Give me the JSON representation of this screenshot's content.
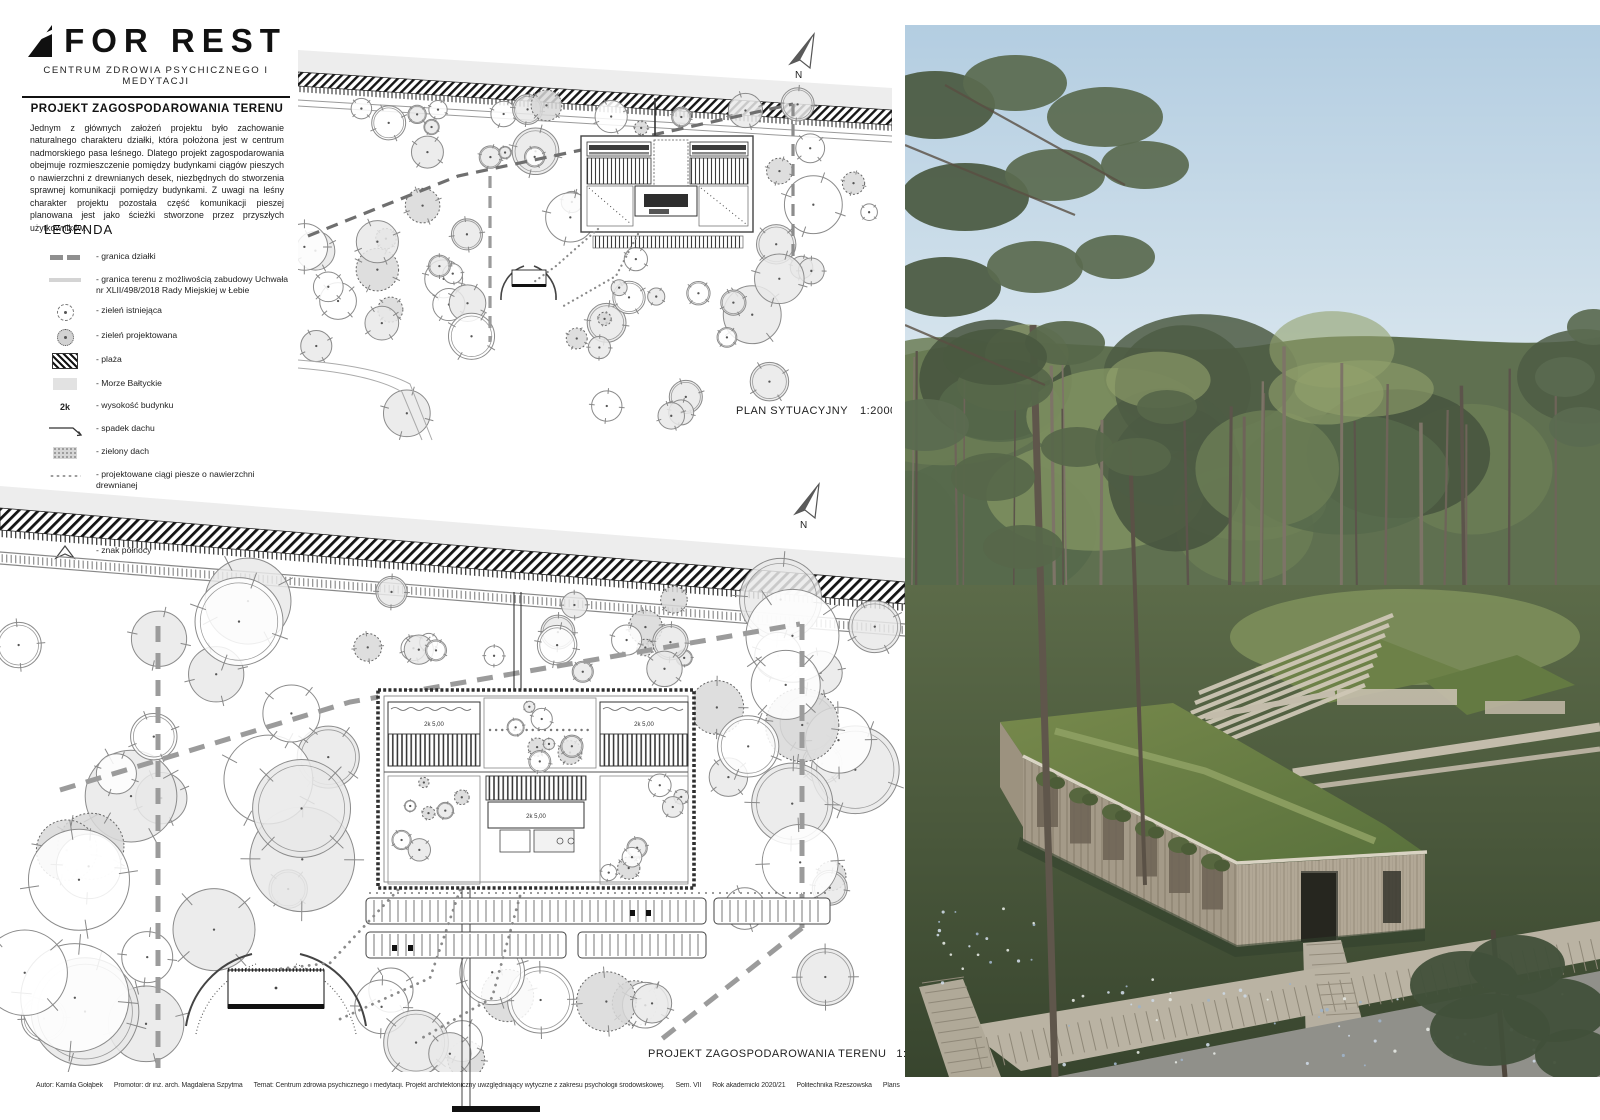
{
  "brand": {
    "logo_text": "FOR REST",
    "subtitle": "CENTRUM ZDROWIA PSYCHICZNEGO I MEDYTACJI"
  },
  "intro": {
    "heading": "PROJEKT ZAGOSPODAROWANIA TERENU",
    "body": "Jednym z głównych założeń projektu było zachowanie naturalnego charakteru działki, która położona jest w centrum nadmorskiego pasa leśnego. Dlatego projekt zagospodarowania obejmuje rozmieszczenie pomiędzy budynkami ciągów pieszych o nawierzchni z drewnianych desek, niezbędnych do stworzenia sprawnej komunikacji pomiędzy budynkami. Z uwagi na leśny charakter projektu pozostała część komunikacji pieszej planowana jest jako ścieżki stworzone przez przyszłych użytkowników."
  },
  "legend": {
    "title": "LEGENDA",
    "items": [
      {
        "icon": "boundary-dash-icon",
        "label": "- granica działki"
      },
      {
        "icon": "buildable-line-icon",
        "label": "- granica terenu z możliwością zabudowy Uchwała nr XLII/498/2018 Rady Miejskiej w Łebie"
      },
      {
        "icon": "existing-green-icon",
        "label": "- zieleń istniejąca"
      },
      {
        "icon": "designed-green-icon",
        "label": "- zieleń projektowana"
      },
      {
        "icon": "beach-hatch-icon",
        "label": "- plaża"
      },
      {
        "icon": "sea-icon",
        "label": "- Morze Bałtyckie"
      },
      {
        "icon": "height-icon",
        "symbol": "2k",
        "label": "- wysokość budynku"
      },
      {
        "icon": "roof-slope-icon",
        "label": "- spadek dachu"
      },
      {
        "icon": "green-roof-icon",
        "label": "- zielony dach"
      },
      {
        "icon": "wood-path-icon",
        "label": "- projektowane ciągi piesze o nawierzchni drewnianej"
      },
      {
        "icon": "trodden-path-icon",
        "label": "- wydeptane ścieżki"
      },
      {
        "icon": "asphalt-road-icon",
        "label": "- droga dojazdowa asfaltowa"
      },
      {
        "icon": "north-icon",
        "label": "- znak północy"
      }
    ]
  },
  "plans": {
    "top": {
      "label": "PLAN SYTUACYJNY",
      "scale": "1:2000",
      "north": "N"
    },
    "bottom": {
      "label": "PROJEKT ZAGOSPODAROWANIA TERENU",
      "scale": "1:1000",
      "north": "N",
      "wing_label": "2k  5,00"
    }
  },
  "credits": {
    "segments": [
      "Autor: Kamila Gołąbek",
      "Promotor: dr inż. arch. Magdalena Szpytma",
      "Temat: Centrum zdrowia psychicznego i medytacji. Projekt architektoniczny uwzględniający wytyczne z zakresu psychologii środowiskowej.",
      "Sem. VII",
      "Rok akademicki 2020/21",
      "Politechnika Rzeszowska",
      "Plansza 2"
    ]
  },
  "colors": {
    "paper": "#ffffff",
    "ink": "#111111",
    "plan_gray": "#8f8f8f",
    "tree_fill": "#e9e9e9",
    "sky": "#b5cfe2",
    "forest": "#5d6e4e",
    "green_roof": "#6b7f44",
    "timber": "#b0a695",
    "boardwalk": "#b8b1a1",
    "road": "#8f8f89"
  }
}
